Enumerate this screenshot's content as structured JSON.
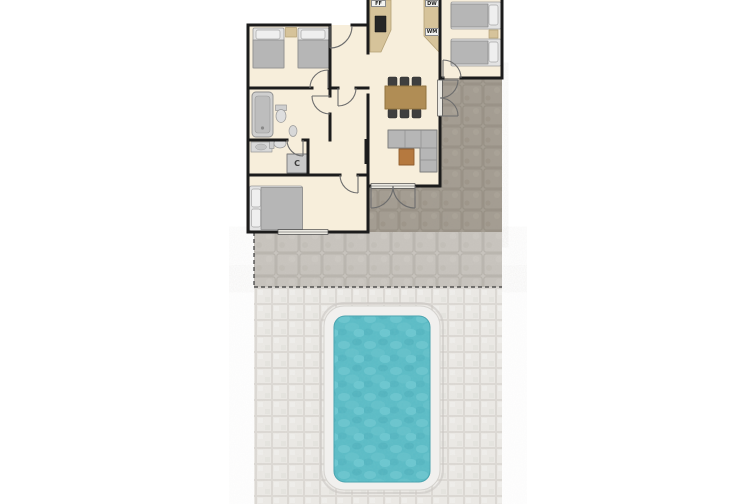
{
  "floor_plan": {
    "appliance_labels": {
      "fridge_freezer": "FF",
      "dishwasher": "DW",
      "washing_machine": "WM",
      "cupboard": "C"
    },
    "colors": {
      "background": "#ffffff",
      "floor": "#f7eedb",
      "wall": "#1b1b1b",
      "counter": "#d6c39a",
      "appliance_dark": "#262626",
      "furniture_gray": "#b6b6b6",
      "furniture_light": "#e9e9e9",
      "table_wood": "#b08d55",
      "ottoman_wood": "#b5793f",
      "chair_dark": "#3f3f3f",
      "patio_stone": "#a49d92",
      "terrace_stone": "#c9c5bf",
      "paving_light": "#eceae6",
      "pool_border": "#f1f0ee",
      "pool_water": "#5bbcc6"
    }
  }
}
